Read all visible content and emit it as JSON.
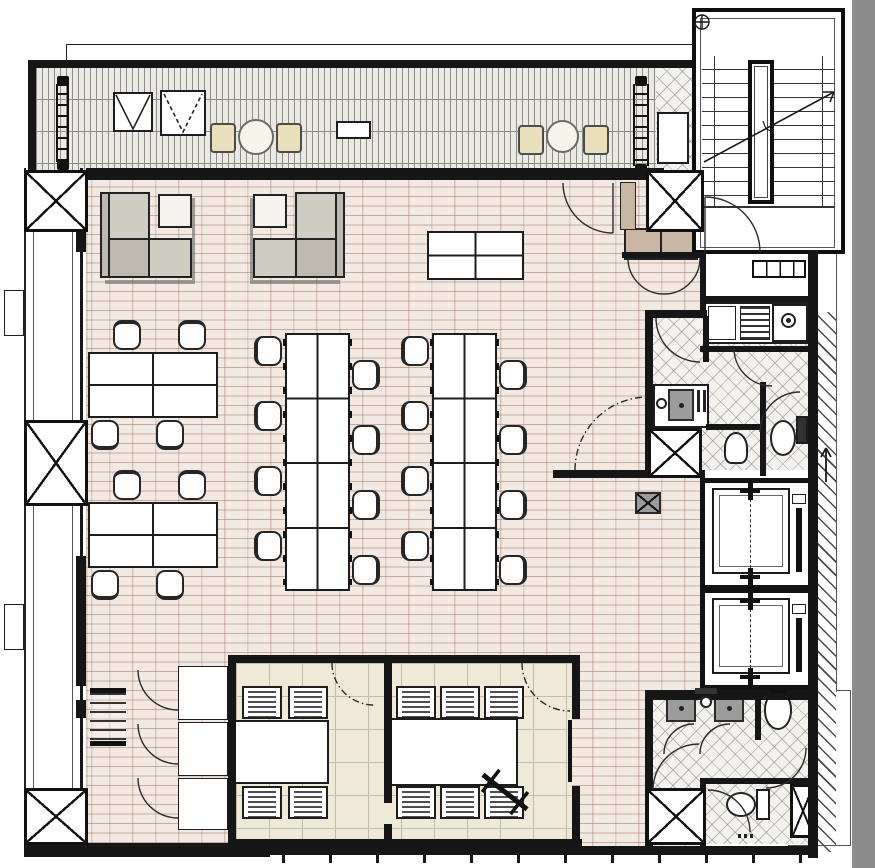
{
  "document": {
    "type": "architectural-floor-plan",
    "description": "office floor plan drawing, no text labels visible",
    "visible_text": []
  },
  "palette": {
    "line": "#161616",
    "plank_floor": "#f2e9e2",
    "plank_joint": "#c9ab9c",
    "tile_floor": "#efe9d7",
    "deck_floor": "#ebe9e4",
    "hatch_floor": "#f3f2ee",
    "sofa_gray": "#cfccc2",
    "sofa_gray_dark": "#bdb9ae",
    "cabinet_tan": "#c9b6a2",
    "deck_chair_cream": "#eae0bb",
    "fixture_gray": "#9c9c9c",
    "viewer_gutter": "#8c8c8c"
  },
  "rooms": [
    "terrace-deck",
    "stairwell",
    "entry-vestibule",
    "kitchenette",
    "wc-mid",
    "open-office",
    "lounge-area",
    "meeting-room-1",
    "meeting-room-2",
    "elevator-1",
    "elevator-2",
    "washroom-south",
    "corridor"
  ],
  "floorplan": {
    "canvas": {
      "w": 875,
      "h": 868
    },
    "furniture": {
      "task_chairs": [
        {
          "x": 113,
          "y": 320,
          "o": "n"
        },
        {
          "x": 178,
          "y": 320,
          "o": "n"
        },
        {
          "x": 91,
          "y": 420,
          "o": "s"
        },
        {
          "x": 156,
          "y": 420,
          "o": "s"
        },
        {
          "x": 113,
          "y": 470,
          "o": "n"
        },
        {
          "x": 178,
          "y": 470,
          "o": "n"
        },
        {
          "x": 91,
          "y": 570,
          "o": "s"
        },
        {
          "x": 156,
          "y": 570,
          "o": "s"
        },
        {
          "x": 254,
          "y": 336,
          "o": "w"
        },
        {
          "x": 254,
          "y": 401,
          "o": "w"
        },
        {
          "x": 254,
          "y": 466,
          "o": "w"
        },
        {
          "x": 254,
          "y": 531,
          "o": "w"
        },
        {
          "x": 352,
          "y": 360,
          "o": "e"
        },
        {
          "x": 352,
          "y": 425,
          "o": "e"
        },
        {
          "x": 352,
          "y": 490,
          "o": "e"
        },
        {
          "x": 352,
          "y": 555,
          "o": "e"
        },
        {
          "x": 401,
          "y": 336,
          "o": "w"
        },
        {
          "x": 401,
          "y": 401,
          "o": "w"
        },
        {
          "x": 401,
          "y": 466,
          "o": "w"
        },
        {
          "x": 401,
          "y": 531,
          "o": "w"
        },
        {
          "x": 499,
          "y": 360,
          "o": "e"
        },
        {
          "x": 499,
          "y": 425,
          "o": "e"
        },
        {
          "x": 499,
          "y": 490,
          "o": "e"
        },
        {
          "x": 499,
          "y": 555,
          "o": "e"
        }
      ],
      "desk_clusters": [
        {
          "x": 88,
          "y": 352,
          "w": 130,
          "h": 66
        },
        {
          "x": 88,
          "y": 502,
          "w": 130,
          "h": 66
        }
      ],
      "bench_desks": [
        {
          "x": 285,
          "y": 333,
          "w": 65,
          "h": 258
        },
        {
          "x": 432,
          "y": 333,
          "w": 65,
          "h": 258
        }
      ],
      "standing_table": {
        "x": 427,
        "y": 231,
        "w": 97,
        "h": 49
      },
      "lounge_sets": [
        {
          "x": 100,
          "y": 192,
          "flip": false
        },
        {
          "x": 253,
          "y": 192,
          "flip": true
        }
      ],
      "meeting_tables": [
        {
          "x": 232,
          "y": 720,
          "w": 97,
          "h": 64
        },
        {
          "x": 390,
          "y": 718,
          "w": 128,
          "h": 68
        }
      ],
      "meeting_chairs": [
        {
          "x": 242,
          "y": 686
        },
        {
          "x": 288,
          "y": 686
        },
        {
          "x": 242,
          "y": 786
        },
        {
          "x": 288,
          "y": 786
        },
        {
          "x": 396,
          "y": 686
        },
        {
          "x": 440,
          "y": 686
        },
        {
          "x": 484,
          "y": 686
        },
        {
          "x": 396,
          "y": 786
        },
        {
          "x": 440,
          "y": 786
        },
        {
          "x": 484,
          "y": 786
        }
      ],
      "storage_cabinets": [
        {
          "x": 178,
          "y": 666,
          "w": 50,
          "h": 54
        },
        {
          "x": 178,
          "y": 722,
          "w": 50,
          "h": 54
        },
        {
          "x": 178,
          "y": 778,
          "w": 50,
          "h": 52
        }
      ],
      "deck_chairs": [
        {
          "x": 210,
          "y": 123
        },
        {
          "x": 276,
          "y": 123
        },
        {
          "x": 518,
          "y": 125
        },
        {
          "x": 583,
          "y": 125
        }
      ],
      "deck_tables": [
        {
          "x": 238,
          "y": 119,
          "d": 36
        },
        {
          "x": 546,
          "y": 120,
          "d": 33
        }
      ],
      "deck_bench": {
        "x": 336,
        "y": 121,
        "w": 35,
        "h": 18
      },
      "skylights": [
        {
          "x": 113,
          "y": 92,
          "w": 40,
          "h": 40,
          "style": "solid"
        },
        {
          "x": 160,
          "y": 90,
          "w": 46,
          "h": 46,
          "style": "dashed"
        }
      ],
      "coat_rack": {
        "x": 90,
        "y": 688,
        "w": 36,
        "h": 58
      },
      "columns": [
        {
          "x": 24,
          "y": 170,
          "w": 64,
          "h": 62
        },
        {
          "x": 646,
          "y": 170,
          "w": 58,
          "h": 62
        },
        {
          "x": 24,
          "y": 420,
          "w": 64,
          "h": 86
        },
        {
          "x": 648,
          "y": 428,
          "w": 54,
          "h": 50
        },
        {
          "x": 24,
          "y": 788,
          "w": 64,
          "h": 57
        },
        {
          "x": 646,
          "y": 788,
          "w": 60,
          "h": 57
        }
      ],
      "elevator_shafts": [
        {
          "x": 700,
          "y": 478,
          "w": 118,
          "h": 112
        },
        {
          "x": 700,
          "y": 588,
          "w": 118,
          "h": 102
        }
      ],
      "bottom_wall_ticks": {
        "x0": 282,
        "step": 47,
        "count": 12,
        "y": 846,
        "h": 17
      }
    }
  }
}
